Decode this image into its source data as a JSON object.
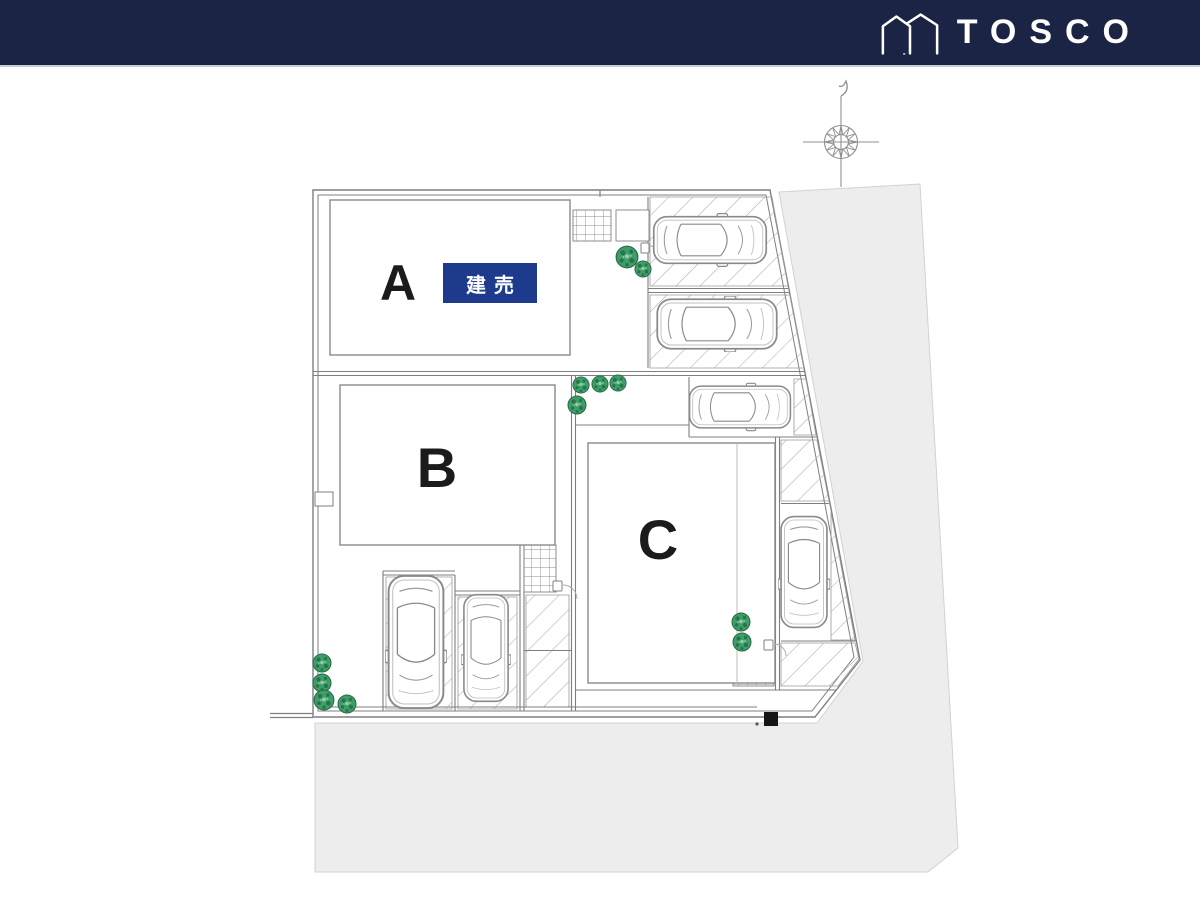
{
  "header": {
    "brand": "TOSCO",
    "logo_icon": "tosco-house-icon",
    "background_color": "#1c2445",
    "divider_color": "#c9cfda"
  },
  "site_plan": {
    "lots": [
      {
        "label": "A",
        "badge": "建売"
      },
      {
        "label": "B"
      },
      {
        "label": "C"
      }
    ],
    "badge": {
      "text": "建売",
      "background_color": "#1d3a8c",
      "text_color": "#ffffff"
    },
    "icons": [
      "compass-icon",
      "tree-icon",
      "car-icon"
    ],
    "counts": {
      "cars": 6,
      "trees": 12
    },
    "colors": {
      "surrounding_area": "#ededed",
      "line": "#808080",
      "tree_green": "#3f9e68",
      "marker_black": "#151515"
    }
  }
}
